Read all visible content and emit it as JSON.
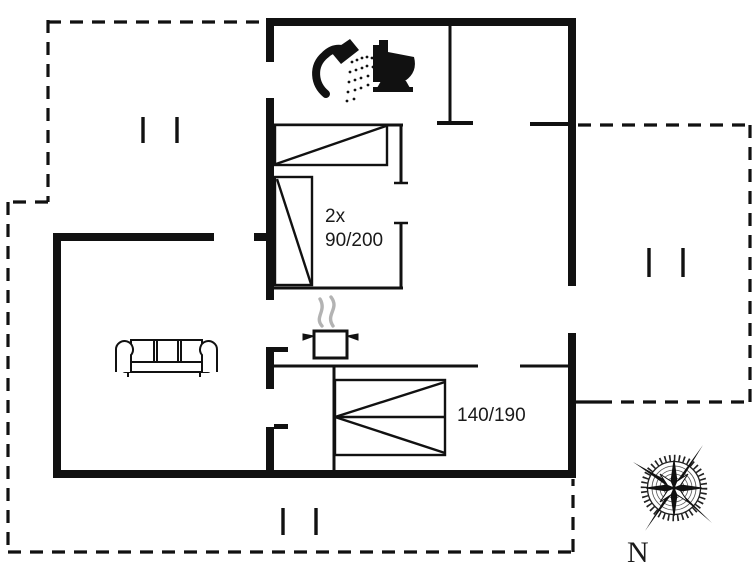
{
  "plan": {
    "colors": {
      "line": "#111111",
      "background": "#ffffff",
      "steam": "#b3b3b3"
    },
    "rooms": {
      "bedroom_small": {
        "label_line1": "2x",
        "label_line2": "90/200"
      },
      "bedroom_double": {
        "label": "140/190"
      }
    },
    "compass": {
      "label": "N"
    },
    "icons": [
      "shower-icon",
      "toilet-icon",
      "stove-pot-icon",
      "steam-icon",
      "sofa-icon",
      "single-bed-icon",
      "single-bed-icon",
      "double-bed-icon",
      "compass-rose-icon",
      "window-tick-icon"
    ]
  }
}
